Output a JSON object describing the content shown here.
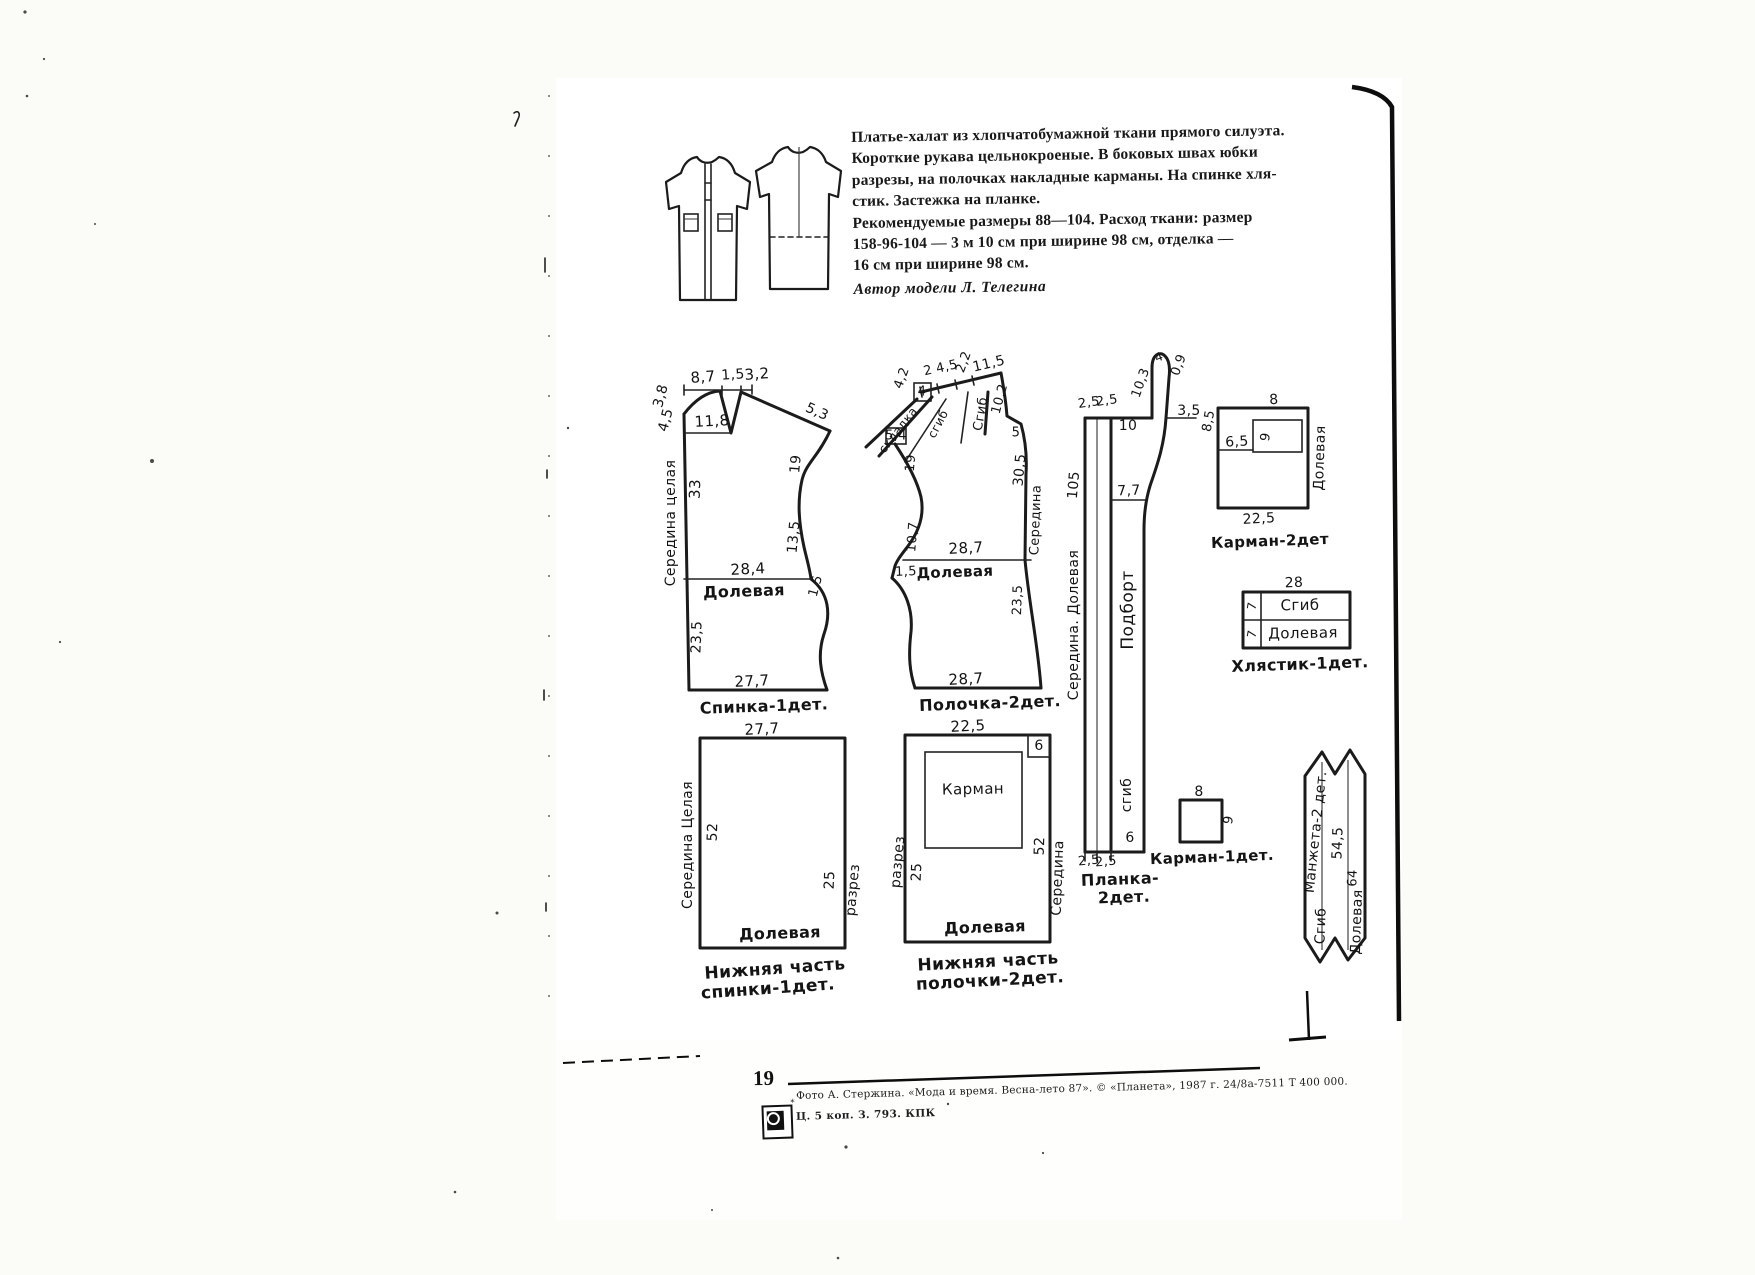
{
  "page": {
    "number": "19"
  },
  "header": {
    "description_lines": [
      "Платье-халат из хлопчатобумажной ткани прямого силуэта.",
      "Короткие рукава цельнокроеные. В боковых швах юбки",
      "разрезы, на полочках накладные карманы. На спинке хля-",
      "стик. Застежка на планке.",
      "Рекомендуемые размеры 88—104. Расход ткани: размер",
      "158-96-104 — 3 м 10 см при ширине 98 см, отделка —",
      "16 см при ширине 98 см."
    ],
    "author_line": "Автор модели Л. Телегина"
  },
  "footer": {
    "credit_line": "Фото А. Стержина. «Мода и время. Весна-лето 87». © «Планета», 1987 г. 24/8а-7511  Т 400 000.",
    "price_line": "Ц. 5 коп. З. 793. КПК",
    "camera_icon": "camera-logo"
  },
  "diagram": {
    "labels": [
      {
        "n": "spinka-dim-8-7",
        "t": "8,7",
        "x": 703,
        "y": 377,
        "r": -4,
        "fs": 15
      },
      {
        "n": "spinka-dim-1-5-top",
        "t": "1,5",
        "x": 733,
        "y": 375,
        "r": -4,
        "fs": 14
      },
      {
        "n": "spinka-dim-3-2",
        "t": "3,2",
        "x": 757,
        "y": 374,
        "r": -4,
        "fs": 15
      },
      {
        "n": "spinka-dim-3-8",
        "t": "3,8",
        "x": 661,
        "y": 396,
        "r": -75,
        "fs": 14
      },
      {
        "n": "spinka-dim-4-5",
        "t": "4,5",
        "x": 666,
        "y": 420,
        "r": -75,
        "fs": 14
      },
      {
        "n": "spinka-dim-11-8",
        "t": "11,8",
        "x": 712,
        "y": 421,
        "r": -3,
        "fs": 15
      },
      {
        "n": "spinka-dim-5-3",
        "t": "5,3",
        "x": 817,
        "y": 412,
        "r": 24,
        "fs": 14
      },
      {
        "n": "spinka-dim-19",
        "t": "19",
        "x": 796,
        "y": 464,
        "r": -85,
        "fs": 14
      },
      {
        "n": "spinka-dim-13-5",
        "t": "13,5",
        "x": 794,
        "y": 537,
        "r": -85,
        "fs": 14
      },
      {
        "n": "spinka-dim-33",
        "t": "33",
        "x": 695,
        "y": 489,
        "r": -88,
        "fs": 15
      },
      {
        "n": "spinka-fold-label",
        "t": "Середина  целая",
        "x": 671,
        "y": 523,
        "r": -90,
        "fs": 14
      },
      {
        "n": "spinka-dim-28-4",
        "t": "28,4",
        "x": 748,
        "y": 569,
        "r": -3,
        "fs": 15
      },
      {
        "n": "spinka-grain-label",
        "t": "Долевая",
        "x": 744,
        "y": 591,
        "r": -2,
        "fs": 16,
        "b": 1
      },
      {
        "n": "spinka-dim-1-5-side",
        "t": "1,5",
        "x": 816,
        "y": 586,
        "r": -75,
        "fs": 13
      },
      {
        "n": "spinka-dim-23-5",
        "t": "23,5",
        "x": 697,
        "y": 637,
        "r": -88,
        "fs": 14
      },
      {
        "n": "spinka-dim-27-7",
        "t": "27,7",
        "x": 752,
        "y": 681,
        "r": -3,
        "fs": 15
      },
      {
        "n": "spinka-caption",
        "t": "Спинка-1дет.",
        "x": 764,
        "y": 706,
        "r": -2,
        "fs": 16,
        "b": 1
      },
      {
        "n": "polochka-dim-4-2",
        "t": "4,2",
        "x": 902,
        "y": 378,
        "r": -70,
        "fs": 13
      },
      {
        "n": "polochka-dim-2",
        "t": "2",
        "x": 928,
        "y": 371,
        "r": -13,
        "fs": 13
      },
      {
        "n": "polochka-dim-4-5",
        "t": "4,5",
        "x": 947,
        "y": 367,
        "r": -13,
        "fs": 13
      },
      {
        "n": "polochka-dim-2-2",
        "t": "2,2",
        "x": 964,
        "y": 362,
        "r": -70,
        "fs": 13
      },
      {
        "n": "polochka-dim-11-5",
        "t": "11,5",
        "x": 989,
        "y": 364,
        "r": -13,
        "fs": 14
      },
      {
        "n": "polochka-dim-4",
        "t": "4",
        "x": 922,
        "y": 392,
        "r": 0,
        "fs": 13
      },
      {
        "n": "polochka-pleat-label-1",
        "t": "складка",
        "x": 898,
        "y": 430,
        "r": -52,
        "fs": 12
      },
      {
        "n": "polochka-pleat-label-2",
        "t": "сгиб",
        "x": 938,
        "y": 424,
        "r": -62,
        "fs": 12
      },
      {
        "n": "polochka-fold-label",
        "t": "Сгиб",
        "x": 981,
        "y": 414,
        "r": -80,
        "fs": 13
      },
      {
        "n": "polochka-dim-10-2",
        "t": "10,2",
        "x": 1000,
        "y": 399,
        "r": -75,
        "fs": 13
      },
      {
        "n": "polochka-dim-5",
        "t": "5",
        "x": 1016,
        "y": 433,
        "r": 0,
        "fs": 13
      },
      {
        "n": "polochka-dim-30-5",
        "t": "30,5",
        "x": 1020,
        "y": 470,
        "r": -85,
        "fs": 14
      },
      {
        "n": "polochka-dim-5-4",
        "t": "5,4",
        "x": 896,
        "y": 436,
        "r": 0,
        "fs": 13
      },
      {
        "n": "polochka-dim-19",
        "t": "19",
        "x": 911,
        "y": 463,
        "r": -85,
        "fs": 13
      },
      {
        "n": "polochka-dim-10-7",
        "t": "10,7",
        "x": 913,
        "y": 537,
        "r": -85,
        "fs": 13
      },
      {
        "n": "polochka-dim-28-7-mid",
        "t": "28,7",
        "x": 966,
        "y": 548,
        "r": -3,
        "fs": 15
      },
      {
        "n": "polochka-dim-1-5",
        "t": "1,5",
        "x": 906,
        "y": 572,
        "r": -2,
        "fs": 13
      },
      {
        "n": "polochka-grain-label",
        "t": "Долевая",
        "x": 955,
        "y": 572,
        "r": -2,
        "fs": 15,
        "b": 1
      },
      {
        "n": "polochka-center-label",
        "t": "Середина",
        "x": 1036,
        "y": 520,
        "r": -88,
        "fs": 13
      },
      {
        "n": "polochka-dim-23-5",
        "t": "23,5",
        "x": 1018,
        "y": 600,
        "r": -88,
        "fs": 13
      },
      {
        "n": "polochka-dim-28-7-bottom",
        "t": "28,7",
        "x": 966,
        "y": 679,
        "r": -3,
        "fs": 15
      },
      {
        "n": "polochka-caption",
        "t": "Полочка-2дет.",
        "x": 990,
        "y": 703,
        "r": -2,
        "fs": 16,
        "b": 1
      },
      {
        "n": "planka-dim-2-5a",
        "t": "2,5",
        "x": 1089,
        "y": 403,
        "r": -8,
        "fs": 13
      },
      {
        "n": "planka-dim-2-5b",
        "t": "2,5",
        "x": 1107,
        "y": 401,
        "r": -8,
        "fs": 13
      },
      {
        "n": "planka-dim-10",
        "t": "10",
        "x": 1128,
        "y": 426,
        "r": 0,
        "fs": 14
      },
      {
        "n": "planka-dim-10-3",
        "t": "10,3",
        "x": 1141,
        "y": 383,
        "r": -70,
        "fs": 13
      },
      {
        "n": "planka-dim-4",
        "t": "4",
        "x": 1159,
        "y": 357,
        "r": -20,
        "fs": 12
      },
      {
        "n": "planka-dim-0-9",
        "t": "0,9",
        "x": 1179,
        "y": 365,
        "r": -70,
        "fs": 13
      },
      {
        "n": "planka-dim-3-5",
        "t": "3,5",
        "x": 1189,
        "y": 411,
        "r": 0,
        "fs": 14
      },
      {
        "n": "planka-dim-105",
        "t": "105",
        "x": 1074,
        "y": 485,
        "r": -85,
        "fs": 14
      },
      {
        "n": "planka-dim-7-7",
        "t": "7,7",
        "x": 1129,
        "y": 491,
        "r": -2,
        "fs": 14
      },
      {
        "n": "planka-center-grain-label",
        "t": "Середина.  Долевая",
        "x": 1074,
        "y": 625,
        "r": -90,
        "fs": 14
      },
      {
        "n": "podbort-label",
        "t": "Подборт",
        "x": 1128,
        "y": 610,
        "r": -90,
        "fs": 17
      },
      {
        "n": "planka-fold-label",
        "t": "сгиб",
        "x": 1127,
        "y": 795,
        "r": -90,
        "fs": 14
      },
      {
        "n": "planka-dim-6",
        "t": "6",
        "x": 1130,
        "y": 838,
        "r": 0,
        "fs": 14
      },
      {
        "n": "planka-dim-2-5c",
        "t": "2,5",
        "x": 1089,
        "y": 861,
        "r": -5,
        "fs": 13
      },
      {
        "n": "planka-dim-2-5d",
        "t": "2,5",
        "x": 1106,
        "y": 862,
        "r": -5,
        "fs": 13
      },
      {
        "n": "planka-caption-1",
        "t": "Планка-",
        "x": 1120,
        "y": 879,
        "r": -2,
        "fs": 16,
        "b": 1
      },
      {
        "n": "planka-caption-2",
        "t": "2дет.",
        "x": 1124,
        "y": 897,
        "r": -2,
        "fs": 16,
        "b": 1
      },
      {
        "n": "karman2-dim-8-5",
        "t": "8,5",
        "x": 1209,
        "y": 421,
        "r": -80,
        "fs": 13
      },
      {
        "n": "karman2-dim-6-5",
        "t": "6,5",
        "x": 1237,
        "y": 442,
        "r": -3,
        "fs": 14
      },
      {
        "n": "karman2-dim-8",
        "t": "8",
        "x": 1274,
        "y": 400,
        "r": -3,
        "fs": 14
      },
      {
        "n": "karman2-dim-9",
        "t": "9",
        "x": 1266,
        "y": 437,
        "r": -80,
        "fs": 13
      },
      {
        "n": "karman2-dim-22-5",
        "t": "22,5",
        "x": 1259,
        "y": 519,
        "r": -3,
        "fs": 14
      },
      {
        "n": "karman2-grain-label",
        "t": "Долевая",
        "x": 1320,
        "y": 458,
        "r": -88,
        "fs": 14
      },
      {
        "n": "karman2-caption",
        "t": "Карман-2дет",
        "x": 1270,
        "y": 541,
        "r": -2,
        "fs": 15,
        "b": 1
      },
      {
        "n": "khlyastik-dim-28",
        "t": "28",
        "x": 1294,
        "y": 583,
        "r": -2,
        "fs": 14
      },
      {
        "n": "khlyastik-dim-7a",
        "t": "7",
        "x": 1252,
        "y": 606,
        "r": -80,
        "fs": 12
      },
      {
        "n": "khlyastik-fold-label",
        "t": "Сгиб",
        "x": 1300,
        "y": 605,
        "r": -1,
        "fs": 15
      },
      {
        "n": "khlyastik-dim-7b",
        "t": "7",
        "x": 1252,
        "y": 634,
        "r": -80,
        "fs": 12
      },
      {
        "n": "khlyastik-grain-label",
        "t": "Долевая",
        "x": 1303,
        "y": 633,
        "r": -1,
        "fs": 15
      },
      {
        "n": "khlyastik-caption",
        "t": "Хлястик-1дет.",
        "x": 1300,
        "y": 664,
        "r": -2,
        "fs": 16,
        "b": 1
      },
      {
        "n": "nizh-spinka-dim-27-7",
        "t": "27,7",
        "x": 762,
        "y": 729,
        "r": -3,
        "fs": 15
      },
      {
        "n": "nizh-spinka-dim-52",
        "t": "52",
        "x": 713,
        "y": 832,
        "r": -88,
        "fs": 14
      },
      {
        "n": "nizh-spinka-center-label",
        "t": "Середина  Целая",
        "x": 688,
        "y": 845,
        "r": -90,
        "fs": 14
      },
      {
        "n": "nizh-spinka-dim-25",
        "t": "25",
        "x": 830,
        "y": 880,
        "r": -88,
        "fs": 14
      },
      {
        "n": "nizh-spinka-razrez-label",
        "t": "разрез",
        "x": 853,
        "y": 890,
        "r": -85,
        "fs": 14
      },
      {
        "n": "nizh-spinka-grain-label",
        "t": "Долевая",
        "x": 780,
        "y": 933,
        "r": -2,
        "fs": 16,
        "b": 1
      },
      {
        "n": "nizh-spinka-caption-1",
        "t": "Нижняя часть",
        "x": 775,
        "y": 969,
        "r": -4,
        "fs": 17,
        "b": 1
      },
      {
        "n": "nizh-spinka-caption-2",
        "t": "спинки-1дет.",
        "x": 768,
        "y": 989,
        "r": -4,
        "fs": 17,
        "b": 1
      },
      {
        "n": "nizh-polochka-dim-22-5",
        "t": "22,5",
        "x": 968,
        "y": 726,
        "r": -3,
        "fs": 15
      },
      {
        "n": "nizh-polochka-dim-6",
        "t": "6",
        "x": 1039,
        "y": 746,
        "r": 0,
        "fs": 14
      },
      {
        "n": "pocket-placement-label",
        "t": "Карман",
        "x": 973,
        "y": 789,
        "r": -1,
        "fs": 15
      },
      {
        "n": "nizh-polochka-dim-52",
        "t": "52",
        "x": 1040,
        "y": 846,
        "r": -88,
        "fs": 14
      },
      {
        "n": "nizh-polochka-dim-25",
        "t": "25",
        "x": 917,
        "y": 872,
        "r": -88,
        "fs": 14
      },
      {
        "n": "nizh-polochka-razrez-label",
        "t": "разрез",
        "x": 898,
        "y": 862,
        "r": -85,
        "fs": 14
      },
      {
        "n": "nizh-polochka-center-label",
        "t": "Середина",
        "x": 1058,
        "y": 878,
        "r": -88,
        "fs": 14
      },
      {
        "n": "nizh-polochka-grain-label",
        "t": "Долевая",
        "x": 985,
        "y": 927,
        "r": -2,
        "fs": 16,
        "b": 1
      },
      {
        "n": "nizh-polochka-caption-1",
        "t": "Нижняя часть",
        "x": 988,
        "y": 962,
        "r": -3,
        "fs": 17,
        "b": 1
      },
      {
        "n": "nizh-polochka-caption-2",
        "t": "полочки-2дет.",
        "x": 990,
        "y": 981,
        "r": -3,
        "fs": 17,
        "b": 1
      },
      {
        "n": "karman1-dim-8",
        "t": "8",
        "x": 1199,
        "y": 792,
        "r": 0,
        "fs": 14
      },
      {
        "n": "karman1-dim-9",
        "t": "9",
        "x": 1229,
        "y": 820,
        "r": -80,
        "fs": 13
      },
      {
        "n": "karman1-caption",
        "t": "Карман-1дет.",
        "x": 1212,
        "y": 857,
        "r": -2,
        "fs": 15,
        "b": 1
      },
      {
        "n": "manzheta-caption",
        "t": "Манжета-2 дет.",
        "x": 1316,
        "y": 832,
        "r": -84,
        "fs": 14
      },
      {
        "n": "manzheta-dim-54-5",
        "t": "54,5",
        "x": 1338,
        "y": 843,
        "r": -88,
        "fs": 14
      },
      {
        "n": "manzheta-fold-label",
        "t": "Сгиб",
        "x": 1321,
        "y": 926,
        "r": -88,
        "fs": 14
      },
      {
        "n": "manzheta-dim-64",
        "t": "64",
        "x": 1353,
        "y": 878,
        "r": -88,
        "fs": 13
      },
      {
        "n": "manzheta-grain-label",
        "t": "Долевая",
        "x": 1357,
        "y": 922,
        "r": -88,
        "fs": 14
      }
    ]
  }
}
